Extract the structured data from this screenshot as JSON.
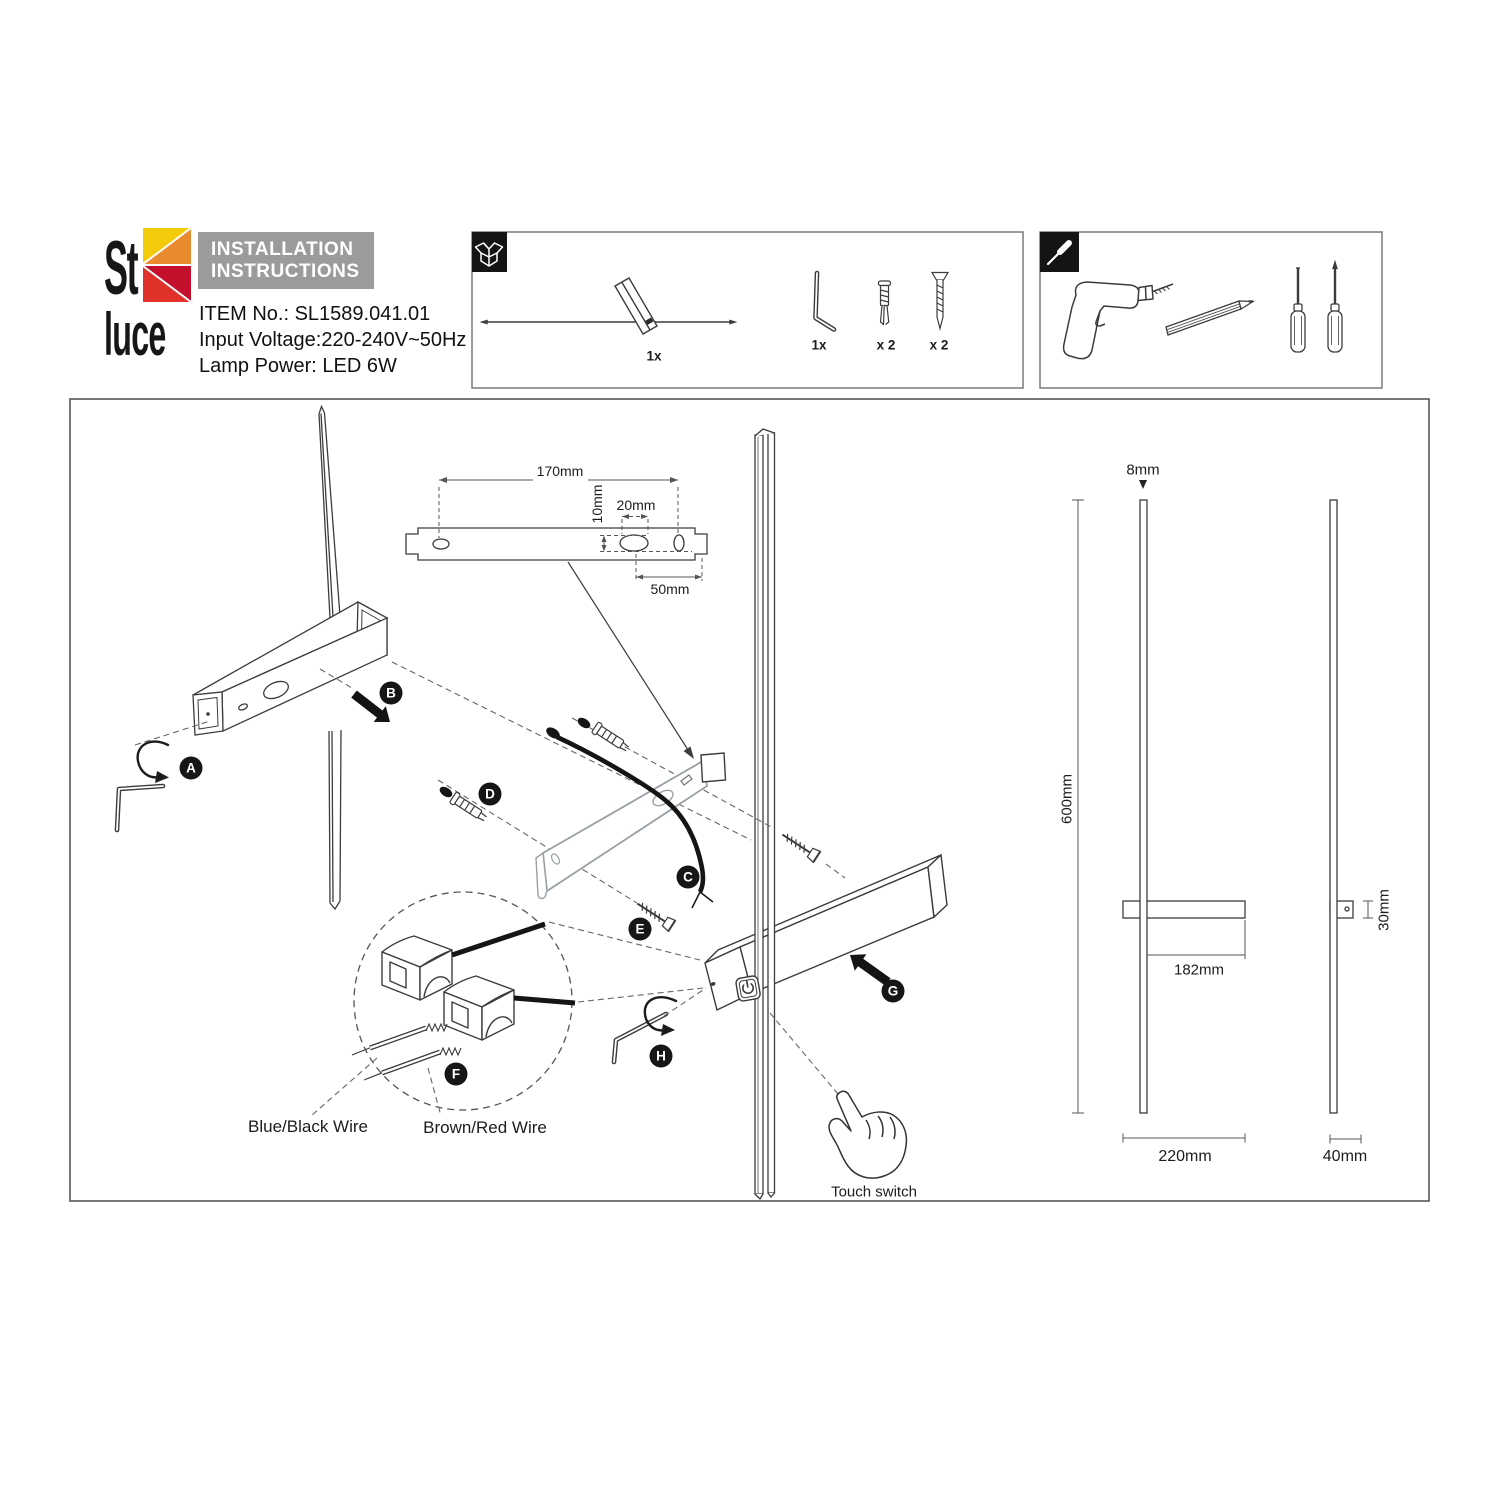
{
  "logo": {
    "word_top": "St",
    "word_bottom": "luce"
  },
  "header": {
    "title_line1": "INSTALLATION",
    "title_line2": "INSTRUCTIONS",
    "item_no": "ITEM No.: SL1589.041.01",
    "input_voltage": "Input Voltage:220-240V~50Hz",
    "lamp_power": "Lamp Power: LED 6W"
  },
  "package_contents": {
    "lamp_qty": "1x",
    "hex_key_qty": "1x",
    "wall_plug_qty": "x 2",
    "screw_qty": "x 2"
  },
  "bracket_detail": {
    "hole_spacing": "170mm",
    "slot_offset": "10mm",
    "slot_width": "20mm",
    "side_offset": "50mm"
  },
  "steps": {
    "a": "A",
    "b": "B",
    "c": "C",
    "d": "D",
    "e": "E",
    "f": "F",
    "g": "G",
    "h": "H"
  },
  "wiring": {
    "neutral": "Blue/Black Wire",
    "live": "Brown/Red Wire"
  },
  "touch_switch_label": "Touch switch",
  "dimensions": {
    "rod_diameter": "8mm",
    "height": "600mm",
    "arm_length": "182mm",
    "width": "220mm",
    "body_height": "30mm",
    "depth": "40mm"
  },
  "colors": {
    "header_bar": "#9B9B9B",
    "logo_yellow": "#F3CB0A",
    "logo_orange": "#EA8A2F",
    "logo_red": "#E0312A",
    "logo_crimson": "#C40F2D",
    "line_art": "#3C3C3C",
    "bracket_gray": "#98A0A5",
    "accent_black": "#141414"
  }
}
